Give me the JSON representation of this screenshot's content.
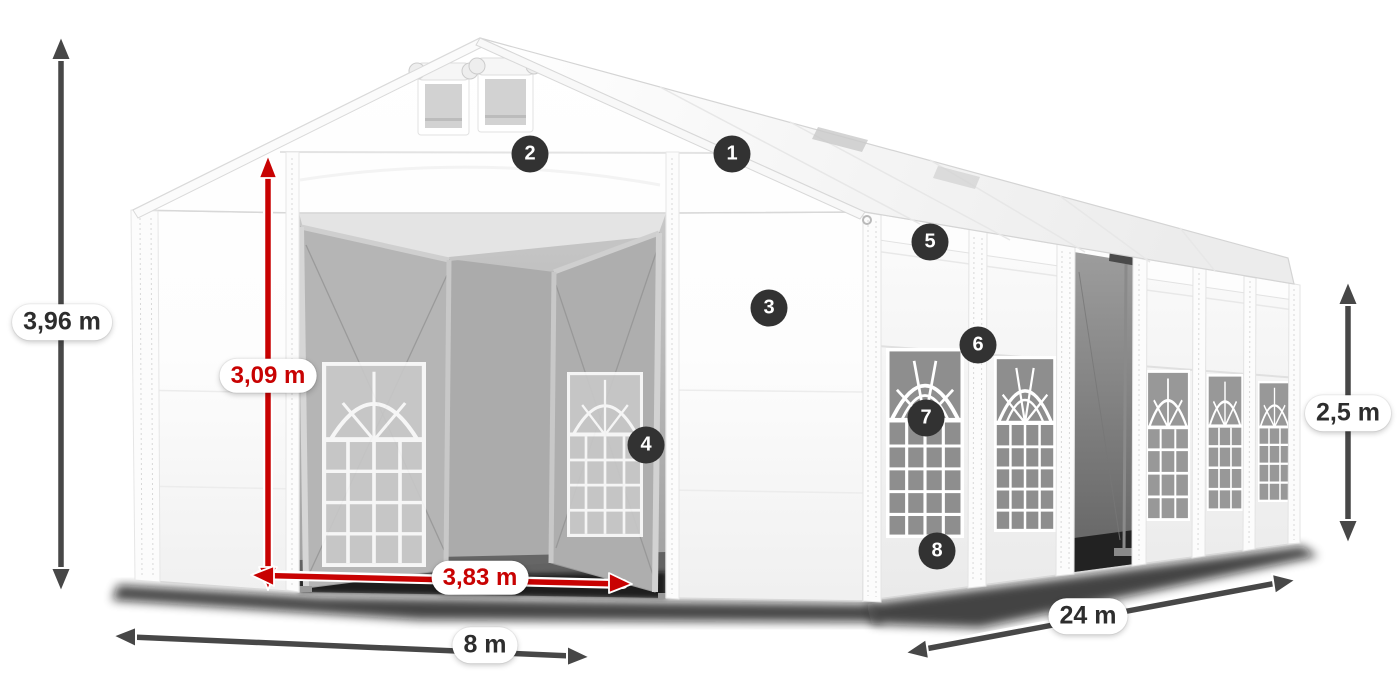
{
  "diagram": {
    "dimensions": {
      "total_height": {
        "label": "3,96 m",
        "style": "dark"
      },
      "entrance_height": {
        "label": "3,09 m",
        "style": "red"
      },
      "entrance_width": {
        "label": "3,83 m",
        "style": "red"
      },
      "width": {
        "label": "8 m",
        "style": "dark"
      },
      "length": {
        "label": "24 m",
        "style": "dark"
      },
      "side_height": {
        "label": "2,5 m",
        "style": "dark"
      }
    },
    "callouts": [
      {
        "number": "1"
      },
      {
        "number": "2"
      },
      {
        "number": "3"
      },
      {
        "number": "4"
      },
      {
        "number": "5"
      },
      {
        "number": "6"
      },
      {
        "number": "7"
      },
      {
        "number": "8"
      }
    ],
    "colors": {
      "dimension_arrow_dark": "#474747",
      "dimension_arrow_red": "#c80202",
      "badge_background": "#323232",
      "badge_text": "#ffffff",
      "label_background": "#ffffff",
      "label_text": "#2d2d2d",
      "background": "#ffffff"
    }
  }
}
